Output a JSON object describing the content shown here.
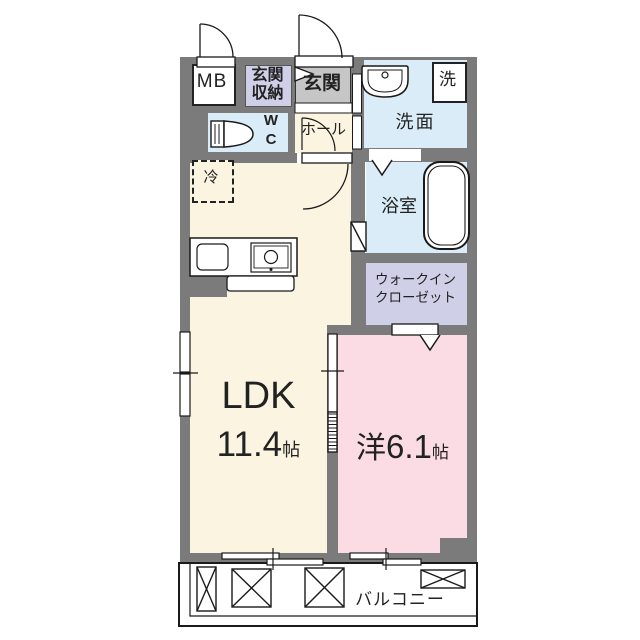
{
  "floorplan": {
    "rooms": {
      "meter_box": {
        "label": "MB"
      },
      "entrance_storage": {
        "line1": "玄関",
        "line2": "収納"
      },
      "entrance": {
        "label": "玄関"
      },
      "washer": {
        "label": "洗"
      },
      "washroom": {
        "label": "洗面"
      },
      "wc": {
        "line1": "W",
        "line2": "C"
      },
      "hall": {
        "label": "ホール"
      },
      "refrigerator": {
        "label": "冷"
      },
      "bathroom": {
        "label": "浴室"
      },
      "walk_in_closet": {
        "line1": "ウォークイン",
        "line2": "クローゼット"
      },
      "ldk": {
        "label": "LDK",
        "size": "11.4",
        "unit": "帖"
      },
      "western_room": {
        "label": "洋",
        "size": "6.1",
        "unit": "帖"
      },
      "balcony": {
        "label": "バルコニー"
      }
    },
    "colors": {
      "wall": "#7b7b7b",
      "ldk_floor": "#faf4e1",
      "western_floor": "#fbdce4",
      "wet_floor": "#d9ecf7",
      "closet_floor": "#cfcfe8",
      "entrance_floor": "#c6c6c6",
      "line": "#1a1a1a"
    }
  }
}
